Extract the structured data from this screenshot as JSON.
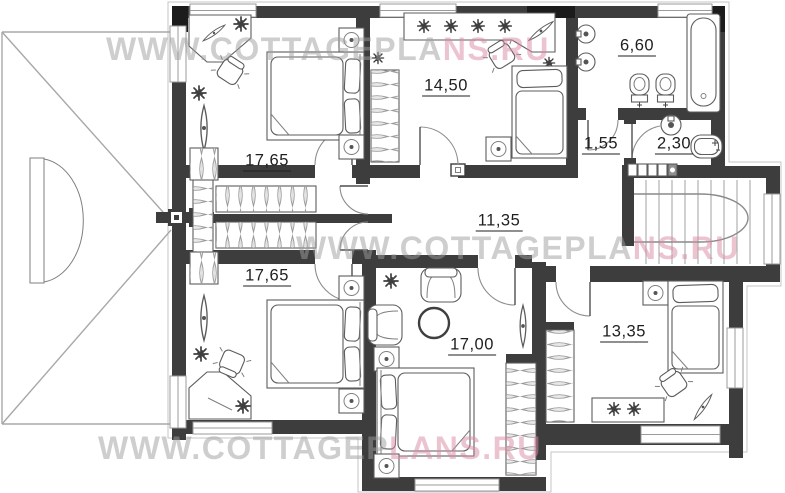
{
  "watermarks": [
    {
      "id": "top",
      "text": "WWW.COTTAGEPLANS.RU",
      "gray": "WWW.COTTAGEPLA",
      "pink": "NS.RU"
    },
    {
      "id": "middle",
      "text": "WWW.COTTAGEPLANS.RU",
      "gray": "WWW.COTTAGEPLA",
      "pink": "NS.RU"
    },
    {
      "id": "bottom",
      "text": "WWW.COTTAGEPLANS.RU",
      "gray": "WWW.COTTAGEP",
      "pink": "LANS.RU"
    }
  ],
  "rooms": [
    {
      "id": "bedroom-top-left",
      "area": "17,65"
    },
    {
      "id": "bedroom-top-middle",
      "area": "14,50"
    },
    {
      "id": "bathroom-large",
      "area": "6,60"
    },
    {
      "id": "vestibule-small",
      "area": "1,55"
    },
    {
      "id": "bathroom-small",
      "area": "2,30"
    },
    {
      "id": "hall",
      "area": "11,35"
    },
    {
      "id": "bedroom-bottom-left",
      "area": "17,65"
    },
    {
      "id": "bedroom-bottom-middle",
      "area": "17,00"
    },
    {
      "id": "bedroom-bottom-right",
      "area": "13,35"
    }
  ],
  "colors": {
    "wall": "#3d3d3d",
    "blackw": "#1c1c1c",
    "line": "#5c5c5c",
    "roof": "#a8a8a8",
    "wm_gray": "#9e9e9e",
    "wm_pink": "#d98ba2",
    "label": "#1f1f1f",
    "bg": "#ffffff"
  }
}
